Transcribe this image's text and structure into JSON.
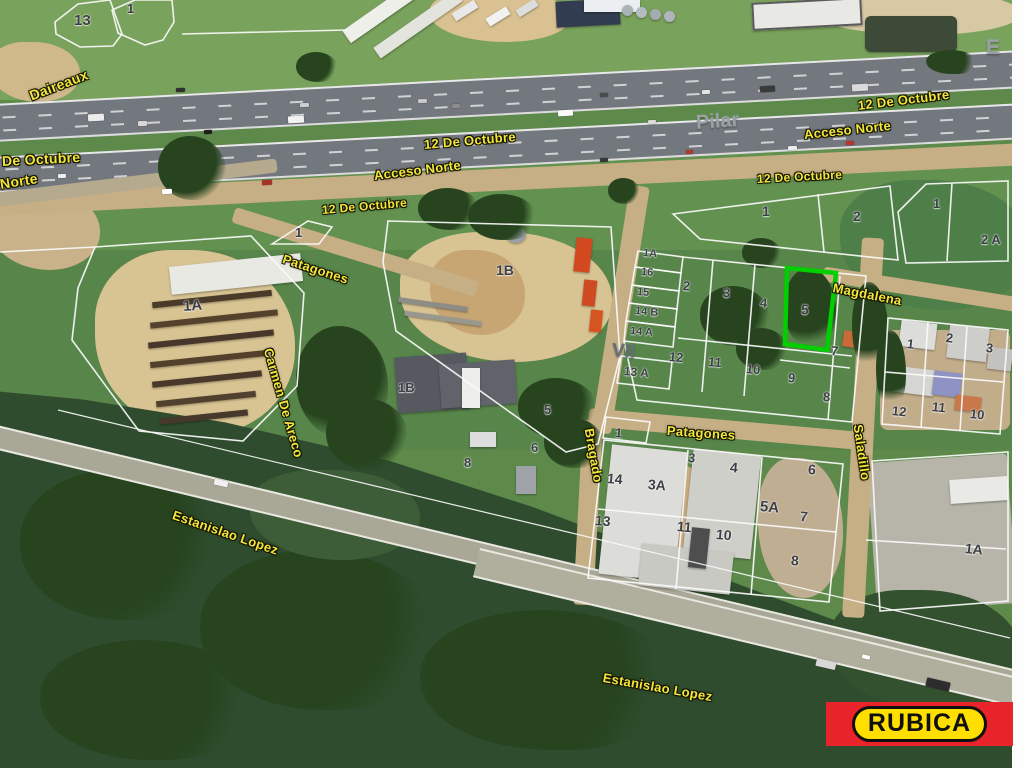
{
  "map": {
    "streets": [
      {
        "text": "Daireaux",
        "x": 30,
        "y": 88,
        "rot": -21,
        "size": 14
      },
      {
        "text": "De Octubre",
        "x": 2,
        "y": 153,
        "rot": -3,
        "size": 14
      },
      {
        "text": "Norte",
        "x": 0,
        "y": 176,
        "rot": -9,
        "size": 14
      },
      {
        "text": "12 De Octubre",
        "x": 424,
        "y": 137,
        "rot": -5,
        "size": 13
      },
      {
        "text": "Acceso Norte",
        "x": 374,
        "y": 168,
        "rot": -7,
        "size": 13
      },
      {
        "text": "12 De Octubre",
        "x": 858,
        "y": 98,
        "rot": -7,
        "size": 13
      },
      {
        "text": "Acceso Norte",
        "x": 804,
        "y": 127,
        "rot": -6,
        "size": 13
      },
      {
        "text": "12 De Octubre",
        "x": 757,
        "y": 172,
        "rot": -3,
        "size": 12
      },
      {
        "text": "12 De Octubre",
        "x": 322,
        "y": 203,
        "rot": -5,
        "size": 12
      },
      {
        "text": "Patagones",
        "x": 283,
        "y": 251,
        "rot": 18,
        "size": 13
      },
      {
        "text": "Magdalena",
        "x": 833,
        "y": 280,
        "rot": 11,
        "size": 13
      },
      {
        "text": "Carmen De Areco",
        "x": 268,
        "y": 341,
        "rot": 74,
        "size": 13
      },
      {
        "text": "Bragado",
        "x": 589,
        "y": 421,
        "rot": 80,
        "size": 13
      },
      {
        "text": "Patagones",
        "x": 667,
        "y": 423,
        "rot": 4,
        "size": 13
      },
      {
        "text": "Saladillo",
        "x": 858,
        "y": 417,
        "rot": 82,
        "size": 13
      },
      {
        "text": "Estanislao Lopez",
        "x": 173,
        "y": 507,
        "rot": 19,
        "size": 13
      },
      {
        "text": "Estanislao Lopez",
        "x": 603,
        "y": 670,
        "rot": 10,
        "size": 13
      }
    ],
    "area_labels": [
      {
        "text": "Pilar",
        "x": 696,
        "y": 112,
        "rot": -4,
        "size": 20,
        "color": "#99a1a4"
      },
      {
        "text": "E",
        "x": 986,
        "y": 36,
        "rot": 0,
        "size": 21,
        "color": "#99a1a4"
      },
      {
        "text": "VII",
        "x": 612,
        "y": 340,
        "rot": 4,
        "size": 19,
        "color": "#636e75"
      }
    ],
    "parcels": [
      {
        "text": "13",
        "x": 74,
        "y": 12,
        "rot": 0,
        "size": 15
      },
      {
        "text": "1",
        "x": 127,
        "y": 1,
        "rot": 0,
        "size": 13
      },
      {
        "text": "1",
        "x": 295,
        "y": 225,
        "rot": 0,
        "size": 13
      },
      {
        "text": "1",
        "x": 762,
        "y": 203,
        "rot": 0,
        "size": 14
      },
      {
        "text": "2",
        "x": 853,
        "y": 208,
        "rot": 0,
        "size": 14
      },
      {
        "text": "1",
        "x": 933,
        "y": 196,
        "rot": 0,
        "size": 13
      },
      {
        "text": "2 A",
        "x": 981,
        "y": 232,
        "rot": 0,
        "size": 13
      },
      {
        "text": "1A",
        "x": 183,
        "y": 298,
        "rot": -4,
        "size": 15
      },
      {
        "text": "1B",
        "x": 496,
        "y": 262,
        "rot": 0,
        "size": 14
      },
      {
        "text": "1B",
        "x": 398,
        "y": 380,
        "rot": 0,
        "size": 13
      },
      {
        "text": "5",
        "x": 544,
        "y": 402,
        "rot": 0,
        "size": 13
      },
      {
        "text": "6",
        "x": 531,
        "y": 440,
        "rot": 0,
        "size": 13
      },
      {
        "text": "8",
        "x": 464,
        "y": 455,
        "rot": 0,
        "size": 13
      },
      {
        "text": "1A",
        "x": 643,
        "y": 247,
        "rot": 5,
        "size": 11
      },
      {
        "text": "16",
        "x": 641,
        "y": 266,
        "rot": 5,
        "size": 11
      },
      {
        "text": "15",
        "x": 637,
        "y": 286,
        "rot": 5,
        "size": 11
      },
      {
        "text": "14 B",
        "x": 635,
        "y": 305,
        "rot": 5,
        "size": 11
      },
      {
        "text": "14 A",
        "x": 630,
        "y": 325,
        "rot": 5,
        "size": 11
      },
      {
        "text": "13 A",
        "x": 624,
        "y": 364,
        "rot": 5,
        "size": 12
      },
      {
        "text": "2",
        "x": 683,
        "y": 278,
        "rot": 5,
        "size": 13
      },
      {
        "text": "3",
        "x": 723,
        "y": 285,
        "rot": 5,
        "size": 13
      },
      {
        "text": "12",
        "x": 669,
        "y": 349,
        "rot": 5,
        "size": 13
      },
      {
        "text": "11",
        "x": 708,
        "y": 354,
        "rot": 5,
        "size": 13
      },
      {
        "text": "10",
        "x": 746,
        "y": 361,
        "rot": 5,
        "size": 13
      },
      {
        "text": "4",
        "x": 760,
        "y": 295,
        "rot": 5,
        "size": 13
      },
      {
        "text": "5",
        "x": 801,
        "y": 301,
        "rot": 5,
        "size": 14
      },
      {
        "text": "7",
        "x": 831,
        "y": 343,
        "rot": 5,
        "size": 13
      },
      {
        "text": "9",
        "x": 788,
        "y": 370,
        "rot": 5,
        "size": 13
      },
      {
        "text": "8",
        "x": 823,
        "y": 389,
        "rot": 5,
        "size": 13
      },
      {
        "text": "1",
        "x": 907,
        "y": 336,
        "rot": 6,
        "size": 13
      },
      {
        "text": "2",
        "x": 946,
        "y": 330,
        "rot": 6,
        "size": 13
      },
      {
        "text": "3",
        "x": 986,
        "y": 340,
        "rot": 6,
        "size": 13
      },
      {
        "text": "12",
        "x": 892,
        "y": 403,
        "rot": 6,
        "size": 13
      },
      {
        "text": "11",
        "x": 932,
        "y": 399,
        "rot": 6,
        "size": 13
      },
      {
        "text": "10",
        "x": 970,
        "y": 406,
        "rot": 6,
        "size": 13
      },
      {
        "text": "1",
        "x": 615,
        "y": 425,
        "rot": 5,
        "size": 13
      },
      {
        "text": "3",
        "x": 688,
        "y": 450,
        "rot": 5,
        "size": 13
      },
      {
        "text": "4",
        "x": 730,
        "y": 459,
        "rot": 5,
        "size": 14
      },
      {
        "text": "14",
        "x": 607,
        "y": 470,
        "rot": 5,
        "size": 14
      },
      {
        "text": "3A",
        "x": 648,
        "y": 476,
        "rot": 5,
        "size": 14
      },
      {
        "text": "5A",
        "x": 760,
        "y": 498,
        "rot": 5,
        "size": 15
      },
      {
        "text": "6",
        "x": 808,
        "y": 461,
        "rot": 5,
        "size": 14
      },
      {
        "text": "7",
        "x": 800,
        "y": 508,
        "rot": 5,
        "size": 14
      },
      {
        "text": "13",
        "x": 595,
        "y": 512,
        "rot": 5,
        "size": 14
      },
      {
        "text": "11",
        "x": 677,
        "y": 518,
        "rot": 5,
        "size": 14
      },
      {
        "text": "10",
        "x": 716,
        "y": 526,
        "rot": 5,
        "size": 14
      },
      {
        "text": "8",
        "x": 791,
        "y": 552,
        "rot": 5,
        "size": 14
      },
      {
        "text": "1A",
        "x": 965,
        "y": 540,
        "rot": 6,
        "size": 14
      }
    ],
    "highlighted_parcel": {
      "label": "5",
      "outline_color": "#00cf00"
    },
    "logo": {
      "text": "RUBICA",
      "band_color": "#e8232a",
      "pill_color": "#ffdf00",
      "text_color": "#101010"
    }
  }
}
